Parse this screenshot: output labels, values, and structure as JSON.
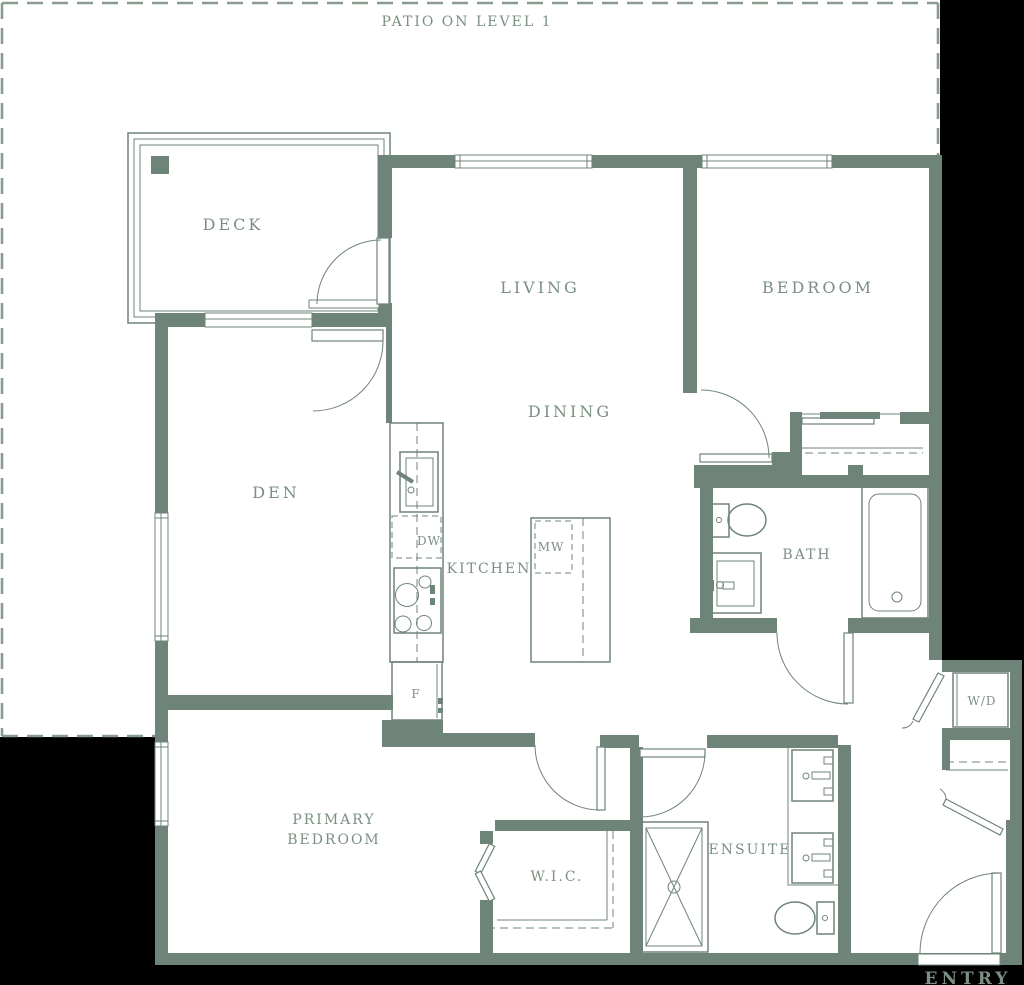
{
  "plan": {
    "patio_label": "PATIO ON LEVEL 1",
    "rooms": {
      "deck": "DECK",
      "living": "LIVING",
      "bedroom": "BEDROOM",
      "den": "DEN",
      "dining": "DINING",
      "kitchen": "KITCHEN",
      "bath": "BATH",
      "primary_bedroom_line1": "PRIMARY",
      "primary_bedroom_line2": "BEDROOM",
      "wic": "W.I.C.",
      "ensuite": "ENSUITE",
      "entry": "ENTRY"
    },
    "appliances": {
      "dishwasher": "DW",
      "microwave": "MW",
      "fridge": "F",
      "washer_dryer": "W/D"
    }
  },
  "colors": {
    "background": "#000000",
    "floor": "#ffffff",
    "wall": "#6f8478",
    "line": "#6f8478",
    "label": "#7b9082",
    "dash": "#8a9c90"
  }
}
